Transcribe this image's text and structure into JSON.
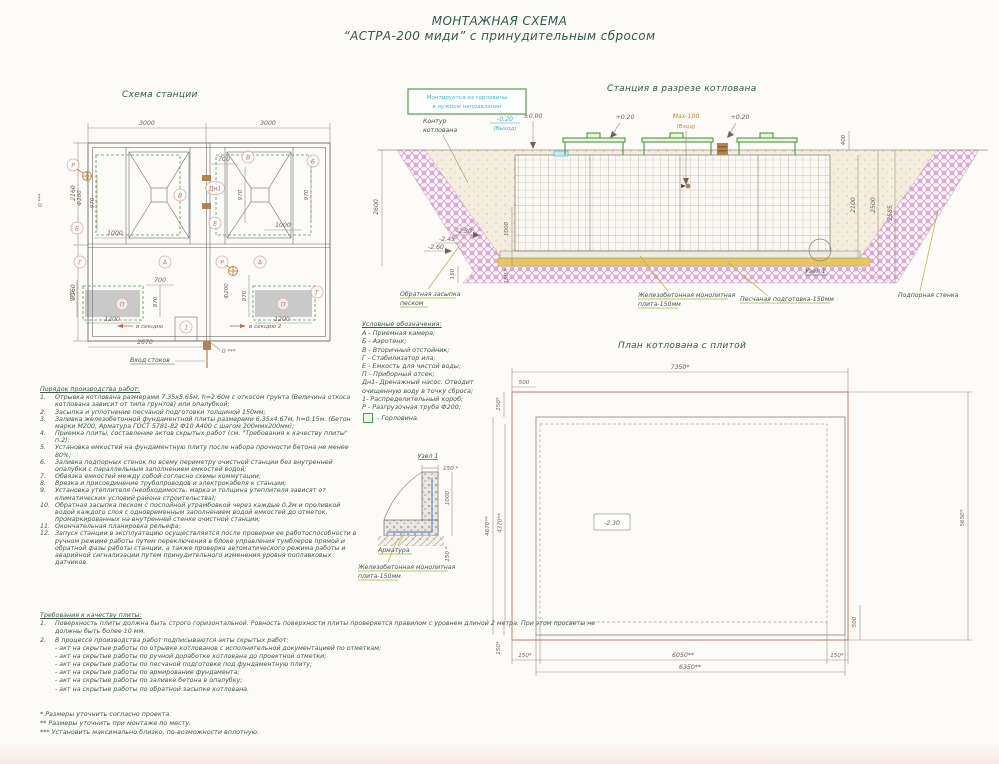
{
  "title": {
    "line1": "МОНТАЖНАЯ СХЕМА",
    "line2": "“АСТРА-200 миди” с принудительным сбросом"
  },
  "station_plan": {
    "title": "Схема станции",
    "dims": {
      "d3000": "3000",
      "d2160": "2160",
      "d700": "700",
      "d970": "970",
      "d1000": "1000",
      "d1200": "1200",
      "d2670": "2670",
      "phi200": "Ф200",
      "zero3": "0 ***"
    },
    "labels": {
      "A": "А",
      "B": "Б",
      "V": "В",
      "G": "Г",
      "E": "Е",
      "P": "П",
      "R": "Р",
      "Dn1": "Дн1",
      "one": "1",
      "to_sec1": "в секцию",
      "to_sec2": "в секцию 2",
      "inlet": "Вход стоков"
    }
  },
  "cross_section": {
    "title": "Станция в разрезе котлована",
    "note": {
      "line1": "Монтируется из горловины",
      "line2": "в нужном направлении"
    },
    "contour": {
      "line1": "Контур",
      "line2": "котлована"
    },
    "marks": {
      "outlet_level": "-0.20",
      "outlet": "(Выход)",
      "zero": "±0.00",
      "plus020a": "+0.20",
      "max100": "Мах-100",
      "inlet": "(Вход)",
      "plus020b": "+0.20"
    },
    "dims": {
      "d2600": "2600",
      "d400": "400",
      "d2100": "2100",
      "d2500": "2500",
      "d2585": "2585",
      "m230": "-2.30",
      "m245": "-2.45",
      "m260": "-2.60",
      "d150": "150",
      "d150s": "150 *",
      "d1000": "1000"
    },
    "labels": {
      "backfill1": "Обратная засыпка",
      "backfill2": "песком",
      "slab1": "Железобетонная монолитная",
      "slab2": "плита-150мм",
      "sand_prep": "Песчаная подготовка-150мм",
      "node1": "Узел 1",
      "retaining": "Подпорная стенка"
    }
  },
  "legend": {
    "title": "Условные обозначения:",
    "items": [
      "А -  Приемная камера;",
      "Б -  Аэротенк;",
      "В -  Вторичный отстойник;",
      "Г -  Стабилизатор ила;",
      "Е -  Емкость для чистой воды;",
      "П -  Приборный отсек;",
      "Дн1- Дренажный насос. Отводит",
      "очищенную воду в точку сброса;",
      "1-  Распределительный короб;",
      "Р -  Разгрузочная труба Ф200;"
    ],
    "neck_item": "-  Горловина."
  },
  "pit_plan": {
    "title": "План котлована с плитой",
    "dims": {
      "d7350": "7350*",
      "d500": "500",
      "d150s": "150*",
      "d4670": "4670**",
      "d4370": "4370**",
      "d6050": "6050**",
      "d6350": "6350**",
      "d5650": "5650*",
      "mark": "-2.30"
    }
  },
  "node_detail": {
    "title": "Узел 1",
    "dims": {
      "d150": "150 *",
      "d1000": "1000"
    },
    "labels": {
      "rebar": "Арматура",
      "slab1": "Железобетонная монолитная",
      "slab2": "плита-150мм"
    }
  },
  "work_order": {
    "title": "Порядок производства работ:",
    "items": [
      {
        "num": "1.",
        "text": "Отрывка котлована размерами 7.35х5.65м, h=2.60м с откосом грунта (Величина откоса котлована зависит от типа грунтов) или опалубкой;"
      },
      {
        "num": "2.",
        "text": "Засыпка и уплотнение песчаной подготовки толщиной 150мм;"
      },
      {
        "num": "3.",
        "text": "Заливка железобетонной фундаментной плиты размерами 6.35х4.67м, h=0.15м. (Бетон марки М200, Арматура ГОСТ 5781-82 Ф10 А400 с шагом 200ммх200мм);"
      },
      {
        "num": "4.",
        "text": "Приемка плиты, составление актов скрытых работ (см. \"Требования к качеству плиты\" п.2);"
      },
      {
        "num": "5.",
        "text": "Установка емкостей на фундаментную плиту после набора прочности бетона не менее 80%;"
      },
      {
        "num": "6.",
        "text": "Заливка подпорных стенок по всему периметру очистной станции без внутренней опалубки с параллельным заполнением емкостей водой;"
      },
      {
        "num": "7.",
        "text": "Обвязка емкостей между собой согласно схемы коммутации;"
      },
      {
        "num": "8.",
        "text": "Врезка и присоединение трубопроводов и электрокабеля к станции;"
      },
      {
        "num": "9.",
        "text": "Установка утеплителя (необходимость, марка и толщина утеплителя зависят от климатических условий района строительства);"
      },
      {
        "num": "10.",
        "text": "Обратная засыпка песком с послойной утрамбовкой через каждые 0.2м и проливкой водой каждого слоя с одновременным заполнением водой емкостей до отметок, промаркированных на внутренней стенке очистной станции;"
      },
      {
        "num": "11.",
        "text": "Окончательная планировка рельефа;"
      },
      {
        "num": "12.",
        "text": "Запуск станции в эксплуатацию осуществляется после проверки ее работоспособности в ручном режиме работы путем переключения в блоке управления тумблеров прямой и обратной фазы работы станции, а также проверка автоматического режима работы и аварийной сигнализации путем принудительного изменения уровня поплавковых датчиков."
      }
    ]
  },
  "quality": {
    "title": "Требования к качеству плиты:",
    "item1": {
      "num": "1.",
      "text": "Поверхность плиты должна быть строго горизонтальной. Ровность поверхности плиты проверяется правилом с уровнем длиной 2 метра. При этом просветы не должны быть  более 10 мм."
    },
    "item2": {
      "num": "2.",
      "text": "В процессе производства работ подписываются акты скрытых работ:"
    },
    "acts": [
      "- акт на скрытые работы по отрывке котлованов с исполнительной документацией по отметкам;",
      "- акт на скрытые работы по ручной доработке котлована до проектной отметки;",
      "- акт на скрытые работы по песчаной подготовке под фундаментную плиту;",
      "- акт на скрытые работы по армирование фундамента;",
      "- акт на скрытые работы по заливке бетона в опалубку;",
      "- акт на скрытые работы по обратной засыпке котлована."
    ]
  },
  "footnotes": [
    "*  Размеры уточнить согласно проекта.",
    "**  Размеры уточнить при монтаже по месту.",
    "***  Установить максимально близко, по-возможности вплотную."
  ],
  "colors": {
    "accent_teal": "#2f5a52",
    "cyan": "#3fb9cc",
    "orange": "#c8833c",
    "red_letters": "#c96a6a",
    "green": "#4aa348",
    "pink_hatch": "#d49cc8",
    "sand": "#f3eedd",
    "yellow_layer": "#e8c55e",
    "plan_red": "#c06a5a"
  }
}
